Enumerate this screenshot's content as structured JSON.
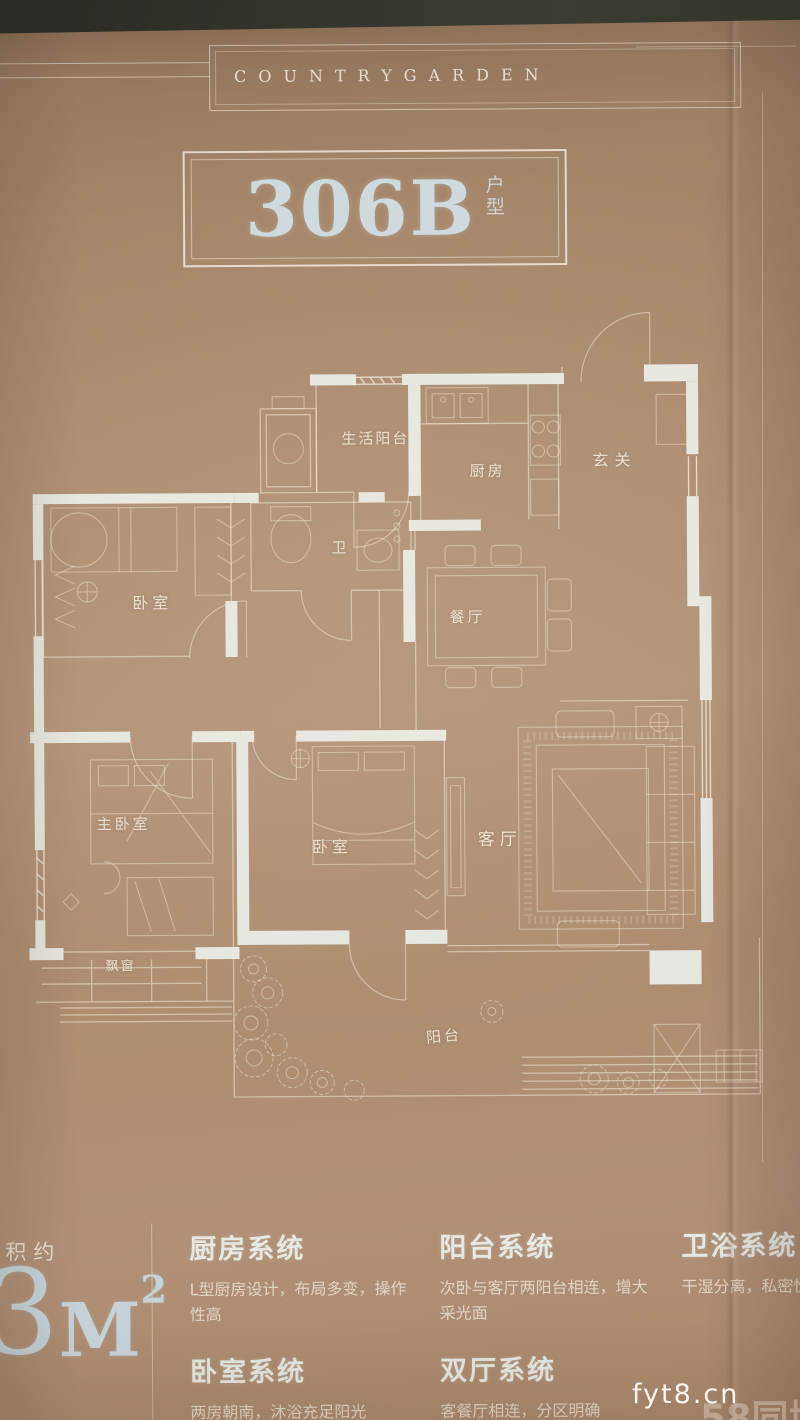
{
  "brand": {
    "name": "COUNTRYGARDEN"
  },
  "unit": {
    "code": "306B",
    "type_char_1": "户",
    "type_char_2": "型"
  },
  "floorplan": {
    "rooms": [
      {
        "id": "service-balcony",
        "label": "生活阳台"
      },
      {
        "id": "kitchen",
        "label": "厨房"
      },
      {
        "id": "foyer",
        "label": "玄关"
      },
      {
        "id": "bedroom-north",
        "label": "卧室"
      },
      {
        "id": "bathroom",
        "label": "卫"
      },
      {
        "id": "dining-room",
        "label": "餐厅"
      },
      {
        "id": "master-bedroom",
        "label": "主卧室"
      },
      {
        "id": "bedroom-second",
        "label": "卧室"
      },
      {
        "id": "living-room",
        "label": "客厅"
      },
      {
        "id": "bay-window",
        "label": "飘窗"
      },
      {
        "id": "balcony",
        "label": "阳台"
      }
    ]
  },
  "stats": {
    "area_prefix": "面积约",
    "area_digit": "3",
    "area_unit": "M",
    "area_sup": "2",
    "layout_suffix": "厅一卫"
  },
  "systems": {
    "column1": [
      {
        "title": "厨房系统",
        "desc": "L型厨房设计，布局多变，操作性高"
      },
      {
        "title": "卧室系统",
        "desc": "两房朝南，沐浴充足阳光"
      }
    ],
    "column2": [
      {
        "title": "阳台系统",
        "desc": "次卧与客厅两阳台相连，增大采光面"
      },
      {
        "title": "双厅系统",
        "desc": "客餐厅相连，分区明确"
      }
    ],
    "column3": [
      {
        "title": "卫浴系统",
        "desc": "干湿分离，私密性"
      }
    ]
  },
  "watermark": {
    "site": "fyt8.cn",
    "platform": "58同城"
  },
  "colors": {
    "paper_tan": "#b09176",
    "line_cream": "#eee6d4",
    "wall_white": "#e9ece6",
    "title_blue_white": "#ccd8dc",
    "dark_edge": "#32332b"
  }
}
